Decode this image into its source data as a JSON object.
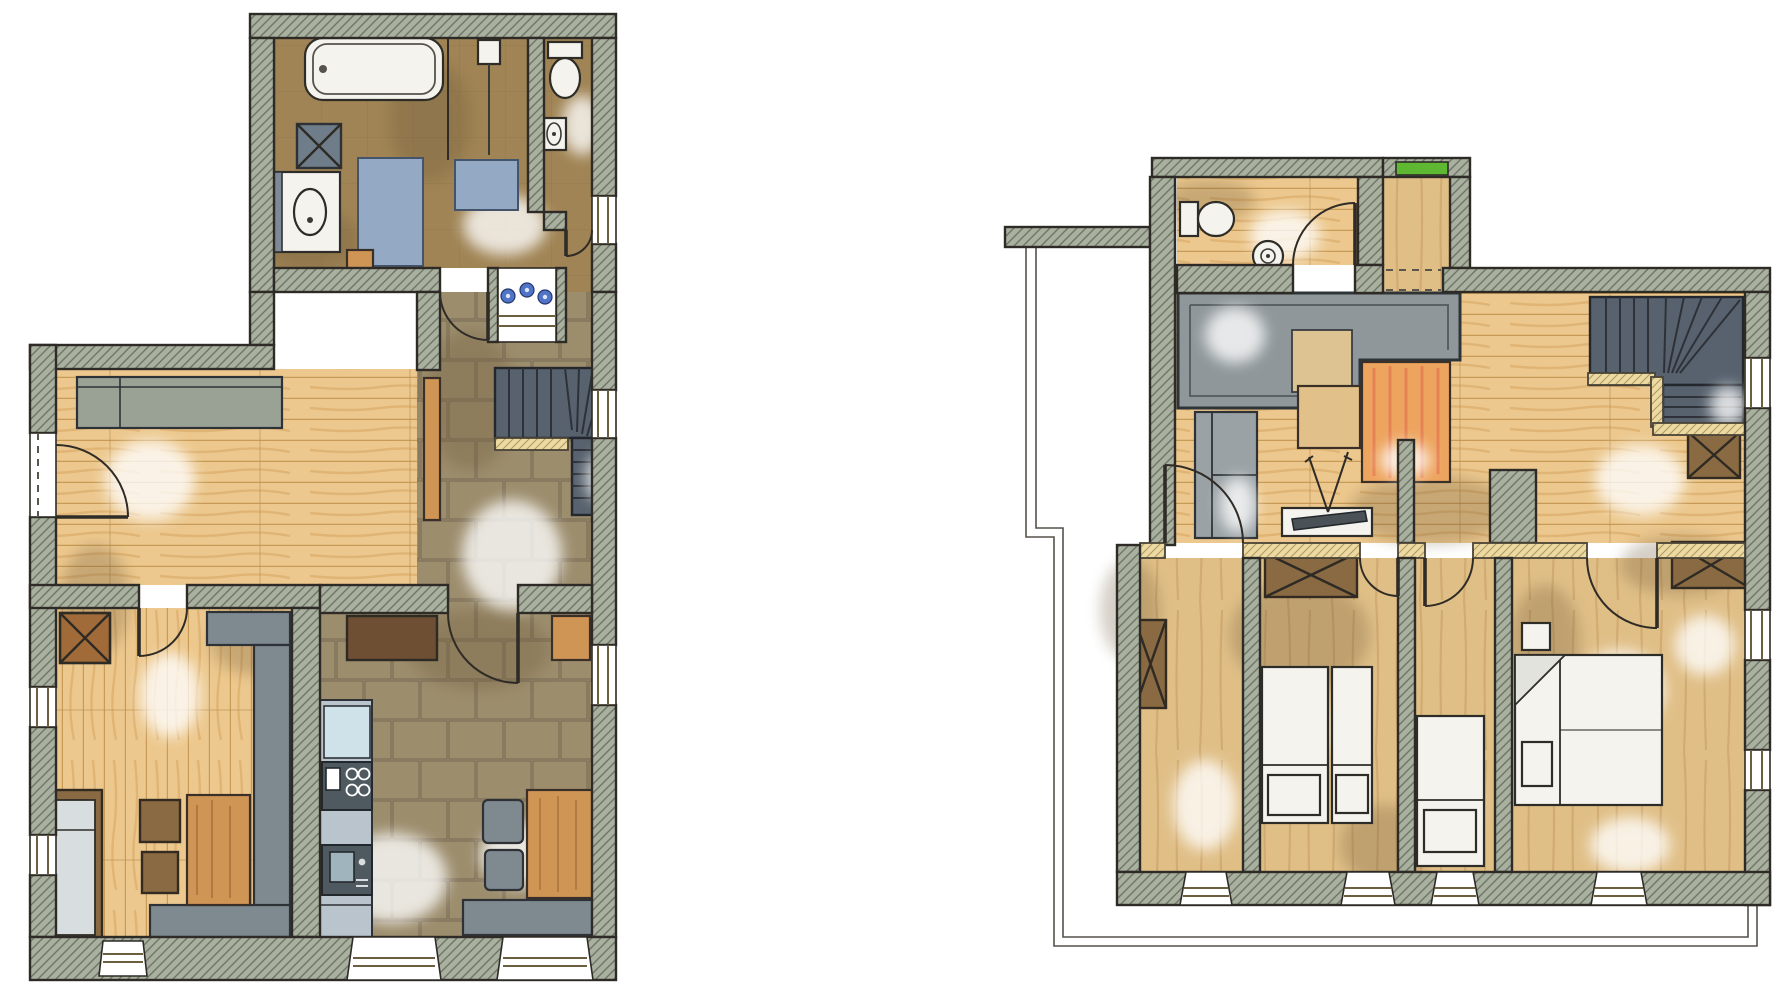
{
  "document": {
    "type": "hand-drawn watercolor floor plan sheet",
    "sheets": 2,
    "visible_text": []
  },
  "colors": {
    "paper": "#ffffff",
    "wall": "#a9b0a0",
    "wallHatch": "#6d7565",
    "outline": "#2e2b26",
    "woodFloor": "#ecc88e",
    "plankLine": "#c79a56",
    "stoneTile": "#9c8d6d",
    "bathFloor": "#a08455",
    "stair": "#57626e",
    "stairDark": "#2e3238",
    "matBlue": "#93a9c4",
    "furnitureGray": "#7e8a90",
    "furnitureWood": "#cf9554",
    "wardrobeBrown": "#8a6a42",
    "bedWhite": "#f4f3ee",
    "rugOrange": "#eda45f",
    "rugRed": "#e0684a",
    "skylightGreen": "#5fb832",
    "thinWallWood": "#ecd9a4"
  },
  "floors": [
    {
      "name": "ground-floor",
      "position": "left",
      "rooms": [
        {
          "name": "bathroom",
          "fixtures": [
            "bathtub",
            "vanity-washbasin",
            "washing-machine",
            "shower",
            "bath-mat-large",
            "bath-mat-small",
            "wooden-mat",
            "door-to-hall"
          ]
        },
        {
          "name": "wc",
          "fixtures": [
            "toilet",
            "hand-basin",
            "door"
          ]
        },
        {
          "name": "hallway",
          "fixtures": [
            "flower-window",
            "winder-staircase",
            "door-to-kitchen"
          ]
        },
        {
          "name": "parlor",
          "fixtures": [
            "wall-bench",
            "entrance-door",
            "open-door-to-hall"
          ]
        },
        {
          "name": "stube",
          "fixtures": [
            "tiled-stove",
            "corner-bench",
            "table",
            "stools",
            "daybed",
            "door"
          ]
        },
        {
          "name": "kitchen-dining",
          "fixtures": [
            "cabinet",
            "refrigerator",
            "kitchen-counter",
            "cooktop-stove",
            "sink",
            "dining-table",
            "dining-bench",
            "chairs"
          ]
        }
      ],
      "windows": [
        "right-wall-x3",
        "left-wall-x2",
        "bottom-wall-splayed-x3",
        "flower-window"
      ]
    },
    {
      "name": "upper-floor",
      "position": "right",
      "rooms": [
        {
          "name": "wc",
          "fixtures": [
            "toilet",
            "round-basin",
            "door"
          ]
        },
        {
          "name": "corridor",
          "fixtures": [
            "green-skylight"
          ]
        },
        {
          "name": "lounge-landing",
          "fixtures": [
            "void-skylight-block",
            "sofa",
            "side-table",
            "orange-rug",
            "tv-sideboard",
            "wardrobe"
          ]
        },
        {
          "name": "staircase",
          "fixtures": [
            "winder-stairs",
            "window"
          ]
        },
        {
          "name": "bedroom-small",
          "fixtures": [
            "wardrobe",
            "window",
            "door"
          ]
        },
        {
          "name": "bedroom-twin",
          "fixtures": [
            "wardrobe",
            "twin-beds",
            "window",
            "door"
          ]
        },
        {
          "name": "bedroom-single",
          "fixtures": [
            "single-bed",
            "window",
            "door"
          ]
        },
        {
          "name": "bedroom-master",
          "fixtures": [
            "double-bed",
            "nightstand-x2",
            "wardrobe",
            "window-x3",
            "door"
          ]
        }
      ],
      "annotations": [
        "roof-outline-double-line",
        "eaves-wall-stub"
      ]
    }
  ]
}
